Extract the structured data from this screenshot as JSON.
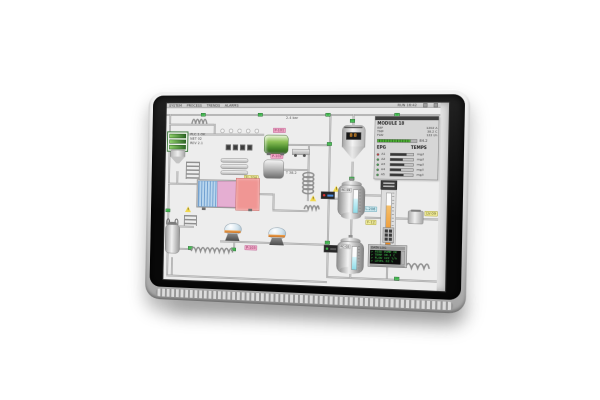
{
  "colors": {
    "red": "#e03232",
    "green": "#3cb54a",
    "orange": "#f09a28",
    "pink": "#f2aac8",
    "yellow": "#f2ee9e",
    "cyan": "#cfeaf0",
    "lcd_green": "#42d152",
    "level_cyan": "#aeeaf4"
  },
  "screen": {
    "menubar": {
      "items": [
        "SYSTEM",
        "PROCESS",
        "TRENDS",
        "ALARMS"
      ],
      "right": "RUN 16:42"
    },
    "legend": {
      "lines": [
        "PLC 1 OK",
        "NET 02",
        "REV 2.1"
      ]
    },
    "pipe_tags": {
      "t1": "2.4 bar",
      "t2": "T 38.2"
    },
    "labels": {
      "pink1": "P-101",
      "pink2": "P-102",
      "pink3": "P-103",
      "yellowA": "FL-204",
      "yellowB": "F-12",
      "yellowC": "LV-09",
      "cyan1": "FL-206",
      "warn": "!"
    },
    "hopper": {
      "value": "88"
    },
    "reactor1": {
      "tag": "RC-01",
      "level_pct": 62
    },
    "reactor2": {
      "tag": "RC-02",
      "level_pct": 55
    },
    "gauge": {
      "fill_pct": 76
    },
    "panel": {
      "title": "MODULE 18",
      "info": [
        {
          "k": "REF",
          "v": "1202 A"
        },
        {
          "k": "TMP",
          "v": "38.2 C"
        },
        {
          "k": "FLW",
          "v": "122 l/h"
        }
      ],
      "progress_pct": 84,
      "progress_label": "84.2",
      "col_left": "EPG",
      "col_right": "TEMPS",
      "rows": [
        {
          "led": "red",
          "label": "A1",
          "bar_pct": 70,
          "value": "mg/l"
        },
        {
          "led": "green",
          "label": "A2",
          "bar_pct": 55,
          "value": "mg/l"
        },
        {
          "led": "green",
          "label": "A3",
          "bar_pct": 62,
          "value": "mg/l"
        },
        {
          "led": "green",
          "label": "A4",
          "bar_pct": 48,
          "value": "mg/l"
        },
        {
          "led": "green",
          "label": "A5",
          "bar_pct": 58,
          "value": "mg/l"
        }
      ]
    },
    "lcd": {
      "header": "DATA LOG",
      "lines": [
        "> FEED PUMP OK",
        "> TEMP 38.2 C",
        "> FLOW 122 l/h",
        "> LEVEL 62 %"
      ]
    }
  }
}
